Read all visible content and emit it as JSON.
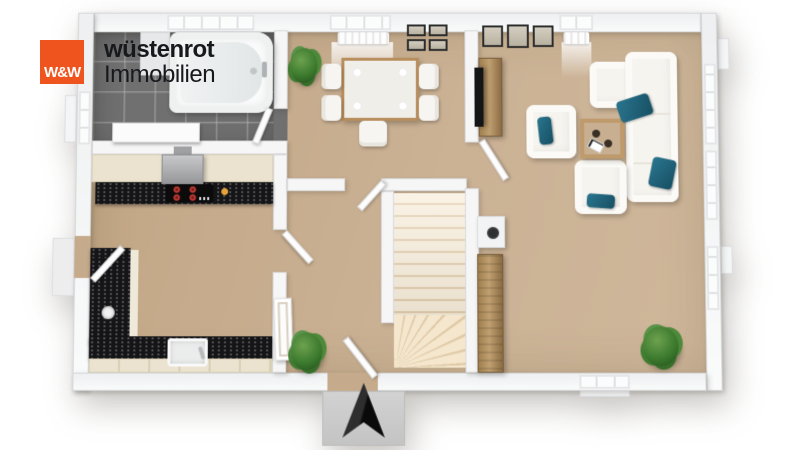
{
  "brand": {
    "monogram": "W&W",
    "wordmark_line1": "wüstenrot",
    "wordmark_line2": "Immobilien",
    "logo_background": "#f0541e",
    "wordmark_color": "#17191d"
  },
  "scene": {
    "kind": "3d-floorplan-top-view",
    "compass": "north-arrow",
    "palette": {
      "floor": "#c7ad8f",
      "bathroom_tile": "#707070",
      "walls": "#f3f4f5",
      "countertop": "#151517",
      "cabinet_fronts": "#ebe3cf",
      "wood_furniture": "#a98a5d",
      "sofa": "#f6f4ef",
      "pillow_accent": "#1f6a85",
      "stair_tread": "#f2e3c9",
      "plant_green": "#3c7a2e",
      "stove_burner_red": "#d5403a",
      "entry_step_concrete": "#c9c9c9"
    },
    "rooms": [
      {
        "name": "bathroom",
        "features": [
          "bathtub",
          "vanity",
          "tiled-floor",
          "door"
        ]
      },
      {
        "name": "kitchen",
        "features": [
          "cooktop-4-burners",
          "extractor-hood",
          "black-stone-countertop",
          "u-shaped-counter",
          "sink",
          "side-door"
        ]
      },
      {
        "name": "dining-area",
        "features": [
          "square-table",
          "5-chairs",
          "window",
          "wall-picture-grid",
          "potted-plant"
        ]
      },
      {
        "name": "living-room",
        "features": [
          "corner-sofa",
          "2-armchairs",
          "coffee-table",
          "tv-on-sideboard",
          "wardrobe",
          "chimney-block",
          "3-wall-pictures",
          "potted-plant",
          "windows"
        ]
      },
      {
        "name": "hallway",
        "features": [
          "staircase",
          "front-door",
          "concrete-entry-step",
          "north-arrow",
          "potted-plant"
        ]
      }
    ]
  }
}
